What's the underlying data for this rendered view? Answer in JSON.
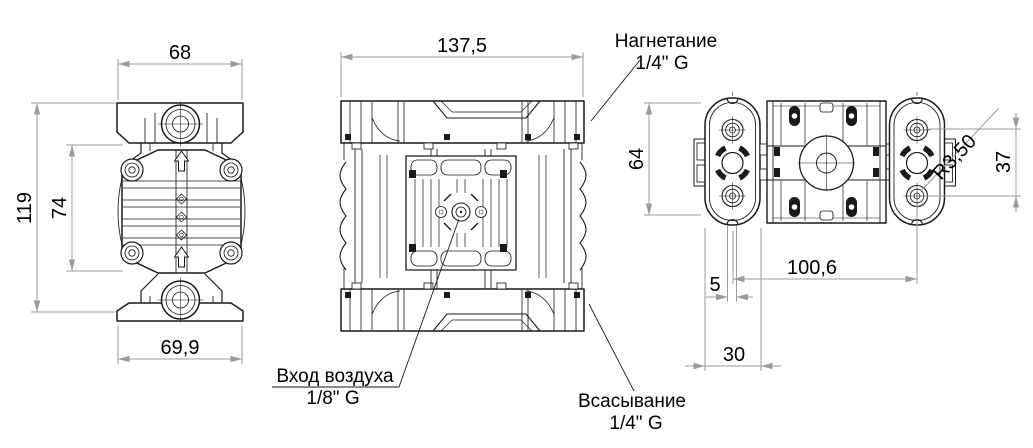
{
  "drawing": {
    "title": "diaphragm-pump-dimensional-drawing",
    "background": "#ffffff",
    "line_color": "#1a1a1a",
    "dim_color": "#9b9b9b",
    "dims": {
      "front_top_width": "68",
      "front_total_height": "119",
      "front_body_height": "74",
      "front_bottom_width": "69,9",
      "side_width": "137,5",
      "top_height": "64",
      "top_bolt_span": "37",
      "corner_radius": "R3,50",
      "bolt_distance": "100,6",
      "notch_width": "5",
      "foot_width": "30"
    },
    "ports": {
      "discharge_label": "Нагнетание",
      "discharge_thread": "1/4\" G",
      "air_inlet_label": "Вход воздуха",
      "air_inlet_thread": "1/8\" G",
      "suction_label": "Всасывание",
      "suction_thread": "1/4\" G"
    }
  }
}
